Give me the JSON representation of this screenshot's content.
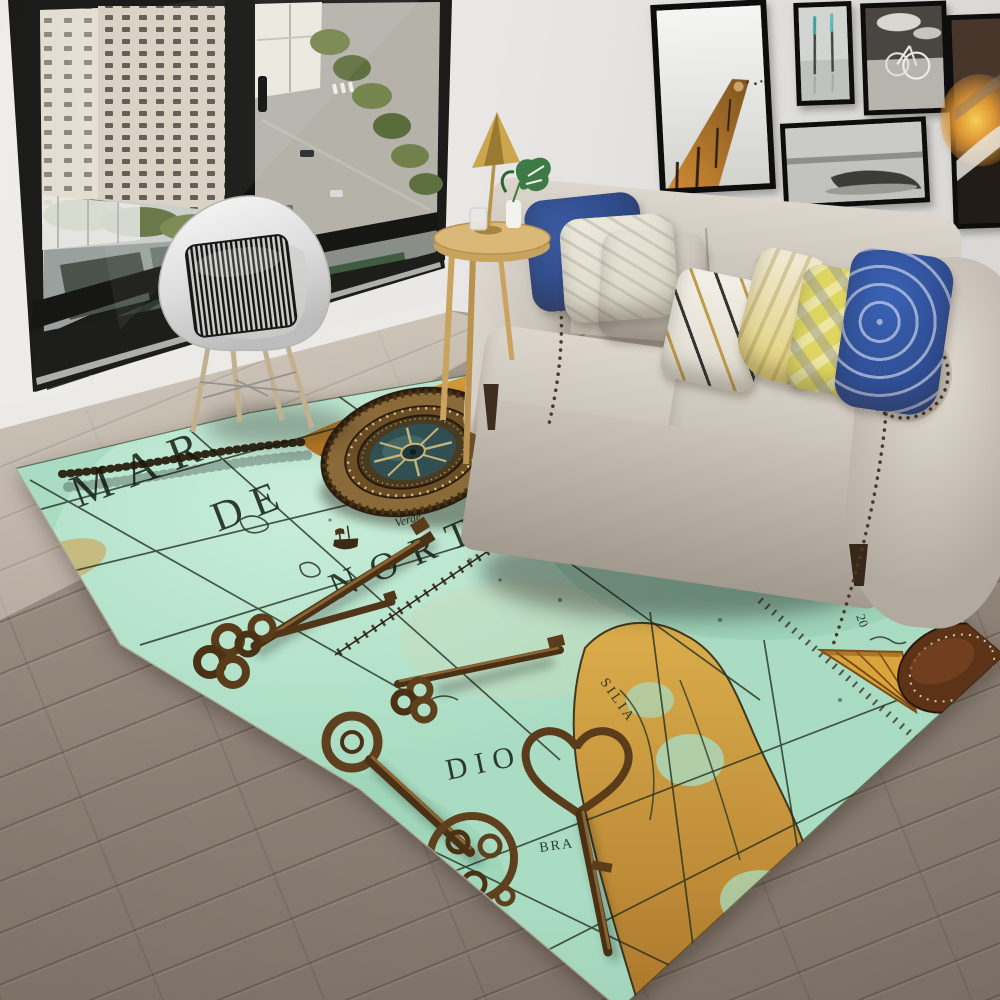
{
  "meta": {
    "title": "Living room photo: vintage nautical map area rug with compass and antique keys"
  },
  "rug": {
    "labels": {
      "mar": "MAR",
      "de": "DE",
      "nort": "NORT",
      "dio": "DIO",
      "cabo_line1": "I. de Cabo",
      "cabo_line2": "Verde",
      "silia": "SILIA",
      "bra": "BRA",
      "aet": "ÆT",
      "lat20": "20"
    },
    "colors": {
      "sea": "#a9dcc2",
      "sea_light": "#c9eeda",
      "land": "#d39232",
      "map_line": "#26321f",
      "bronze": "#6e4d26",
      "compass_face": "#2f4f52",
      "leather": "#5d3318"
    }
  },
  "palette": {
    "wall": "#e7e6e4",
    "floor": "#8b7f74",
    "window_frame": "#171717",
    "sofa": "#cfc8be",
    "pillow_blue": "#2e4a8c",
    "pillow_yellow": "#e5d96a",
    "chair_shell": "#ececec",
    "lamp_gold": "#b8913f",
    "table_wood": "#d9b878"
  }
}
